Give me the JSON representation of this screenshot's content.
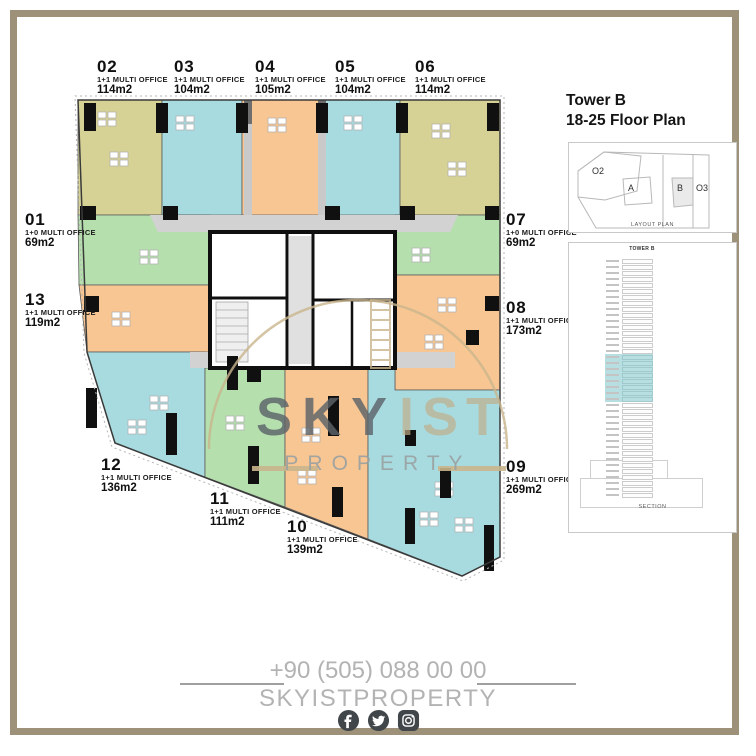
{
  "sidebar": {
    "title_line1": "Tower B",
    "title_line2": "18-25 Floor Plan",
    "layout_plan": {
      "caption": "LAYOUT PLAN",
      "zones": [
        "O2",
        "A",
        "B",
        "O3"
      ],
      "highlighted_zone": "B"
    },
    "section": {
      "caption": "SECTION",
      "tower_label": "TOWER B",
      "floors_total": 40,
      "highlight_start_row": 16,
      "highlight_end_row": 23,
      "highlight_color": "#b7dfe1"
    }
  },
  "units": [
    {
      "id": "01",
      "type": "1+0 MULTI OFFICE",
      "area": "69m2",
      "color": "#b6dfae"
    },
    {
      "id": "02",
      "type": "1+1 MULTI OFFICE",
      "area": "114m2",
      "color": "#d6d295"
    },
    {
      "id": "03",
      "type": "1+1 MULTI OFFICE",
      "area": "104m2",
      "color": "#a8dbdf"
    },
    {
      "id": "04",
      "type": "1+1 MULTI OFFICE",
      "area": "105m2",
      "color": "#f8c693"
    },
    {
      "id": "05",
      "type": "1+1 MULTI OFFICE",
      "area": "104m2",
      "color": "#a8dbdf"
    },
    {
      "id": "06",
      "type": "1+1 MULTI OFFICE",
      "area": "114m2",
      "color": "#d6d295"
    },
    {
      "id": "07",
      "type": "1+0 MULTI OFFICE",
      "area": "69m2",
      "color": "#b6dfae"
    },
    {
      "id": "08",
      "type": "1+1 MULTI OFFICE",
      "area": "173m2",
      "color": "#f8c693"
    },
    {
      "id": "09",
      "type": "1+1 MULTI OFFICE",
      "area": "269m2",
      "color": "#a8dbdf"
    },
    {
      "id": "10",
      "type": "1+1 MULTI OFFICE",
      "area": "139m2",
      "color": "#f8c693"
    },
    {
      "id": "11",
      "type": "1+1 MULTI OFFICE",
      "area": "111m2",
      "color": "#b6dfae"
    },
    {
      "id": "12",
      "type": "1+1 MULTI OFFICE",
      "area": "136m2",
      "color": "#a8dbdf"
    },
    {
      "id": "13",
      "type": "1+1 MULTI OFFICE",
      "area": "119m2",
      "color": "#f8c693"
    }
  ],
  "watermark": {
    "word1": "SKY",
    "word2": "IST",
    "word3": "PROPERTY"
  },
  "footer": {
    "phone": "+90 (505) 088 00 00",
    "brand": "SKYISTPROPERTY",
    "social": [
      "facebook",
      "twitter",
      "instagram"
    ]
  },
  "colors": {
    "frame": "#9e9179",
    "watermark_tan": "#c9b58c",
    "watermark_gray": "#5d646a",
    "corridor_gray": "#d2d2d2",
    "footer_gray": "#b3b3b3",
    "social_icon": "#41464a"
  }
}
